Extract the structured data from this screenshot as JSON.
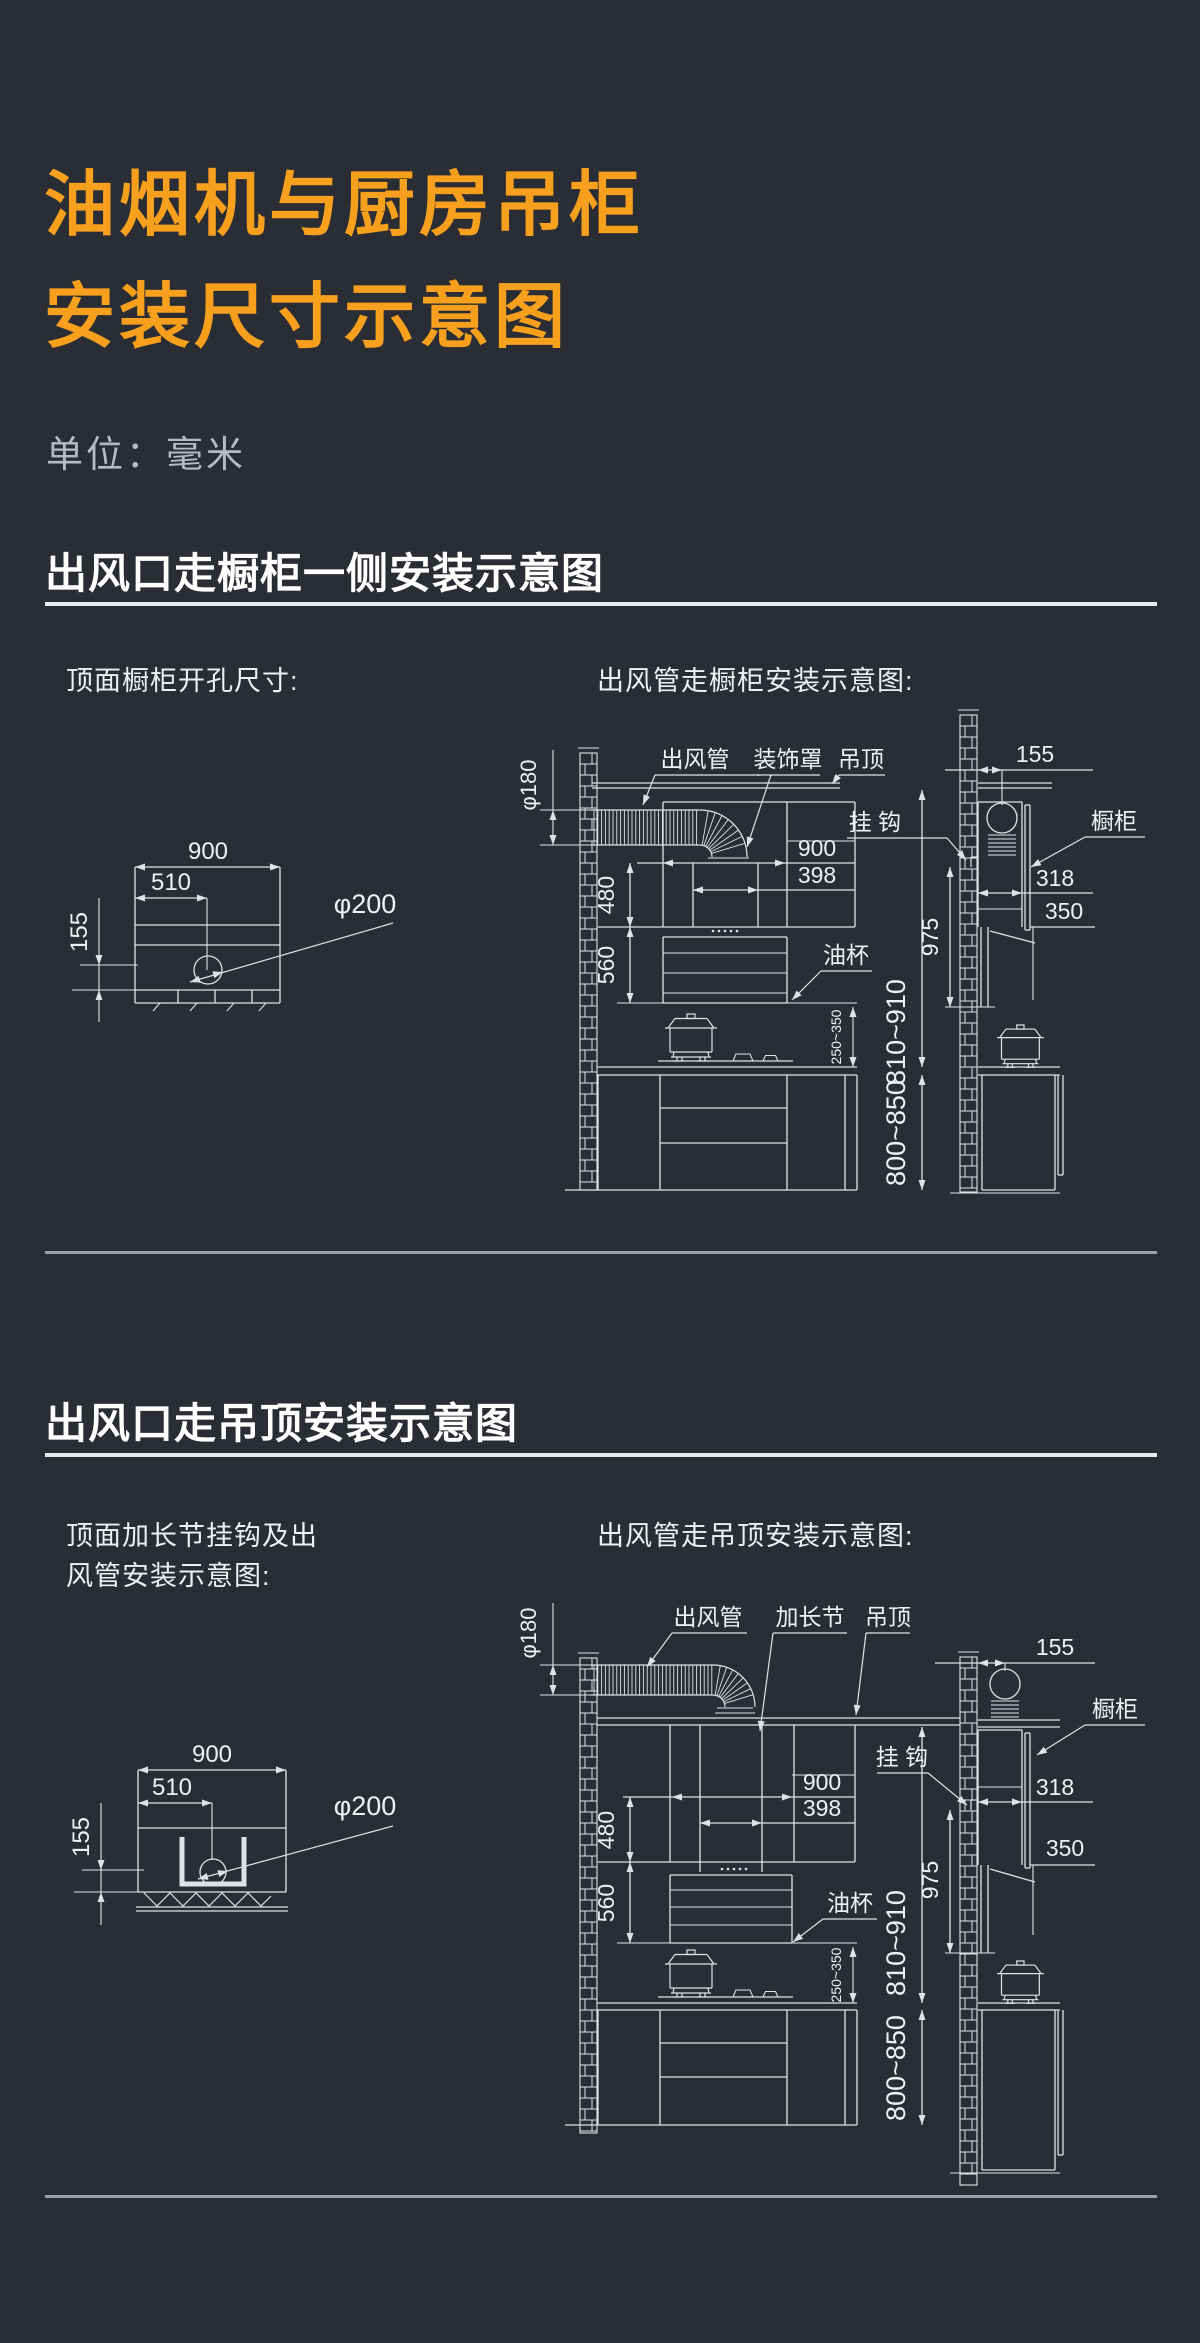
{
  "page": {
    "background": "#2b2d35",
    "accent_color": "#f6a01e",
    "line_color": "#dfe3e7"
  },
  "header": {
    "title_line1": "油烟机与厨房吊柜",
    "title_line2": "安装尺寸示意图",
    "unit_label": "单位：毫米"
  },
  "sections": [
    {
      "heading": "出风口走橱柜一侧安装示意图",
      "left_caption_line1": "顶面橱柜开孔尺寸:",
      "left_caption_line2": "",
      "right_caption": "出风管走橱柜安装示意图:",
      "top_view": {
        "width": "900",
        "hole_offset": "510",
        "edge_offset": "155",
        "hole_diameter": "φ200"
      },
      "elevation": {
        "labels": {
          "duct": "出风管",
          "connector": "装饰罩",
          "ceiling": "吊顶",
          "hook": "挂 钩",
          "cabinet": "橱柜",
          "oil_cup": "油杯"
        },
        "dims": {
          "duct_diameter": "φ180",
          "hood_width": "900",
          "chimney_width": "398",
          "upper_height": "480",
          "hood_section_height": "560",
          "wall_gap": "155",
          "cabinet_depth": "318",
          "cabinet_clearance": "350",
          "hang_height": "975",
          "hood_to_counter_range": "810~910",
          "base_cabinet_range": "800~850",
          "pot_clearance_range": "250~350"
        }
      }
    },
    {
      "heading": "出风口走吊顶安装示意图",
      "left_caption_line1": "顶面加长节挂钩及出",
      "left_caption_line2": "风管安装示意图:",
      "right_caption": "出风管走吊顶安装示意图:",
      "top_view": {
        "width": "900",
        "hole_offset": "510",
        "edge_offset": "155",
        "hole_diameter": "φ200"
      },
      "elevation": {
        "labels": {
          "duct": "出风管",
          "connector": "加长节",
          "ceiling": "吊顶",
          "hook": "挂 钩",
          "cabinet": "橱柜",
          "oil_cup": "油杯"
        },
        "dims": {
          "duct_diameter": "φ180",
          "hood_width": "900",
          "chimney_width": "398",
          "upper_height": "480",
          "hood_section_height": "560",
          "wall_gap": "155",
          "cabinet_depth": "318",
          "cabinet_clearance": "350",
          "hang_height": "975",
          "hood_to_counter_range": "810~910",
          "base_cabinet_range": "800~850",
          "pot_clearance_range": "250~350"
        }
      }
    }
  ]
}
